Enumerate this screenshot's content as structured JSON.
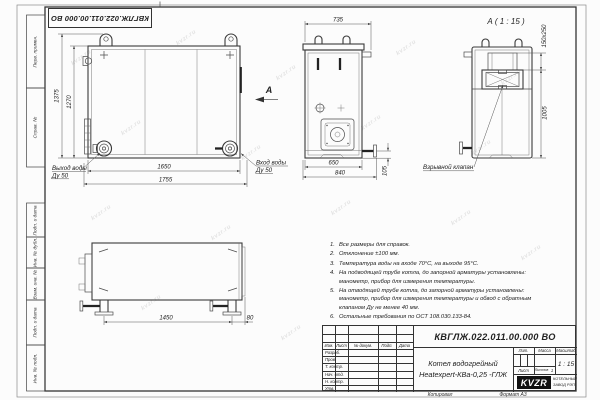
{
  "sheet": {
    "doc_number": "КВГЛЖ.022.011.00.000 ВО",
    "watermark": "kvzr.ru",
    "kopiroval": "Копировал",
    "format": "Формат А3"
  },
  "margin": {
    "perv_primen": "Перв. примен.",
    "sprav_no": "Справ. №",
    "podp_data1": "Подп. и дата",
    "inv_dubl": "Инв. № дубл.",
    "vzam_inv": "Взам. инв. №",
    "podp_data2": "Подп. и дата",
    "inv_podl": "Инв. № подл."
  },
  "front_view": {
    "dim_height_full": "1375",
    "dim_height_body": "1270",
    "dim_width_body": "1650",
    "dim_width_full": "1755",
    "outlet_line1": "Выход воды",
    "outlet_line2": "Ду 50",
    "inlet_line1": "Вход воды",
    "inlet_line2": "Ду 50",
    "view_letter": "А"
  },
  "side_view": {
    "dim_top": "735",
    "dim_body": "650",
    "dim_full": "840",
    "dim_pipe": "105"
  },
  "section_view": {
    "title": "А ( 1 : 15 )",
    "dim_valve": "150x250",
    "dim_height": "1005",
    "valve_label": "Взрывной клапан"
  },
  "bottom_view": {
    "dim_span": "1450",
    "dim_offset": "80"
  },
  "notes": [
    {
      "num": "1.",
      "text": "Все размеры для справок."
    },
    {
      "num": "2.",
      "text": "Отклонение ±100 мм."
    },
    {
      "num": "3.",
      "text": "Температура воды на входе 70°С, на выходе 95°С."
    },
    {
      "num": "4.",
      "text": "На подводящей трубе котла, до запорной арматуры установлены: манометр, прибор для измерения температуры."
    },
    {
      "num": "5.",
      "text": "На отводящей трубе котла, до запорной арматуры установлены: манометр, прибор для измерения температуры и обвод с обратным клапаном Ду не менее 40 мм."
    },
    {
      "num": "6.",
      "text": "Остальные требования по ОСТ 108.030.133-84."
    }
  ],
  "title_block": {
    "col_izm": "Изм.",
    "col_list": "Лист",
    "col_docum": "№ докум.",
    "col_podp": "Подп.",
    "col_data": "Дата",
    "row_razrab": "Разраб.",
    "row_prov": "Пров.",
    "row_tkontr": "Т. контр.",
    "row_nachotd": "Нач. отд.",
    "row_nkontr": "Н. контр.",
    "row_utv": "Утв.",
    "name_line1": "Котел водогрейный",
    "name_line2": "Heatexpert-КВа-0,25 -ГЛЖ",
    "lit": "Лит.",
    "massa": "Масса",
    "masshtab": "Масштаб",
    "scale": "1 : 15",
    "list": "Лист",
    "listov": "Листов",
    "listov_val": "1",
    "logo": "KVZR",
    "company_line1": "КОТЕЛЬНЫЙ",
    "company_line2": "ЗАВОД РЭП"
  },
  "colors": {
    "line": "#3a3a3a",
    "logo_bg": "#111111"
  }
}
